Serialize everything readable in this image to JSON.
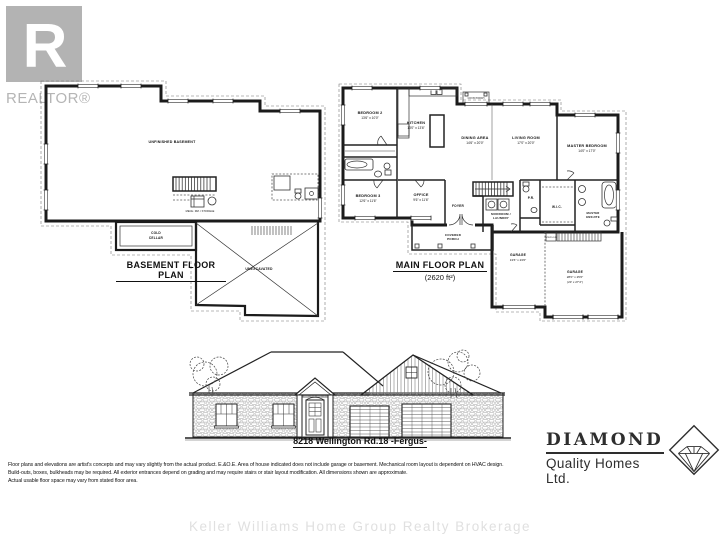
{
  "realtor": {
    "logo_letter": "R",
    "label": "REALTOR®"
  },
  "basement_plan": {
    "title": "BASEMENT FLOOR PLAN",
    "labels": {
      "unfinished": "UNFINISHED BASEMENT",
      "cold1": "COLD",
      "cold2": "CELLAR",
      "unexcavated": "UNEXCAVATED",
      "mech": "MECH. RM. / STORAGE"
    }
  },
  "main_plan": {
    "title": "MAIN FLOOR PLAN",
    "area": "(2620 ft²)",
    "rooms": {
      "bedroom2": {
        "name": "BEDROOM 2",
        "dims": "13'6\" x 10'0\""
      },
      "kitchen": {
        "name": "KITCHEN",
        "dims": "13'0\" x 13'6\""
      },
      "dining": {
        "name": "DINING AREA",
        "dims": "14'6\" x 20'0\""
      },
      "living": {
        "name": "LIVING ROOM",
        "dims": "17'0\" x 20'0\""
      },
      "master": {
        "name": "MASTER BEDROOM",
        "dims": "14'0\" x 17'0\""
      },
      "bedroom3": {
        "name": "BEDROOM 3",
        "dims": "12'6\" x 11'6\""
      },
      "office": {
        "name": "OFFICE",
        "dims": "9'6\" x 11'6\""
      },
      "foyer": "FOYER",
      "mudroom1": "MUDROOM /",
      "mudroom2": "LAUNDRY",
      "powder": "P.R.",
      "wic": "W.I.C.",
      "ensuite1": "MASTER",
      "ensuite2": "ENSUITE",
      "porch1": "COVERED",
      "porch2": "PORCH",
      "rear_porch": "COV'D PORCH",
      "steps": "STEPS DN",
      "garage_single": {
        "name": "GARAGE",
        "dims": "13'6\" x 23'0\""
      },
      "garage_main": {
        "name": "GARAGE",
        "dims": "28'0\" x 25'0\"",
        "note": "(23' x 27'4\")"
      }
    }
  },
  "elevation": {
    "address": "8218 Wellington Rd.18 -Fergus-"
  },
  "builder": {
    "name": "DIAMOND",
    "subtitle": "Quality Homes Ltd."
  },
  "disclaimer": {
    "line1": "Floor plans and elevations are artist's concepts and may vary slightly from the actual product. E.&O.E. Area of house indicated does not include garage or basement. Mechanical room layout is dependent on HVAC design.",
    "line2": "Build-outs, boxes, bulkheads may be required. All exterior entrances depend on grading and may require stairs or stair layout modification. All dimensions shown are approximate.",
    "line3": "Actual usable floor space may vary from stated floor area."
  },
  "watermark": "Keller Williams Home Group Realty Brokerage"
}
